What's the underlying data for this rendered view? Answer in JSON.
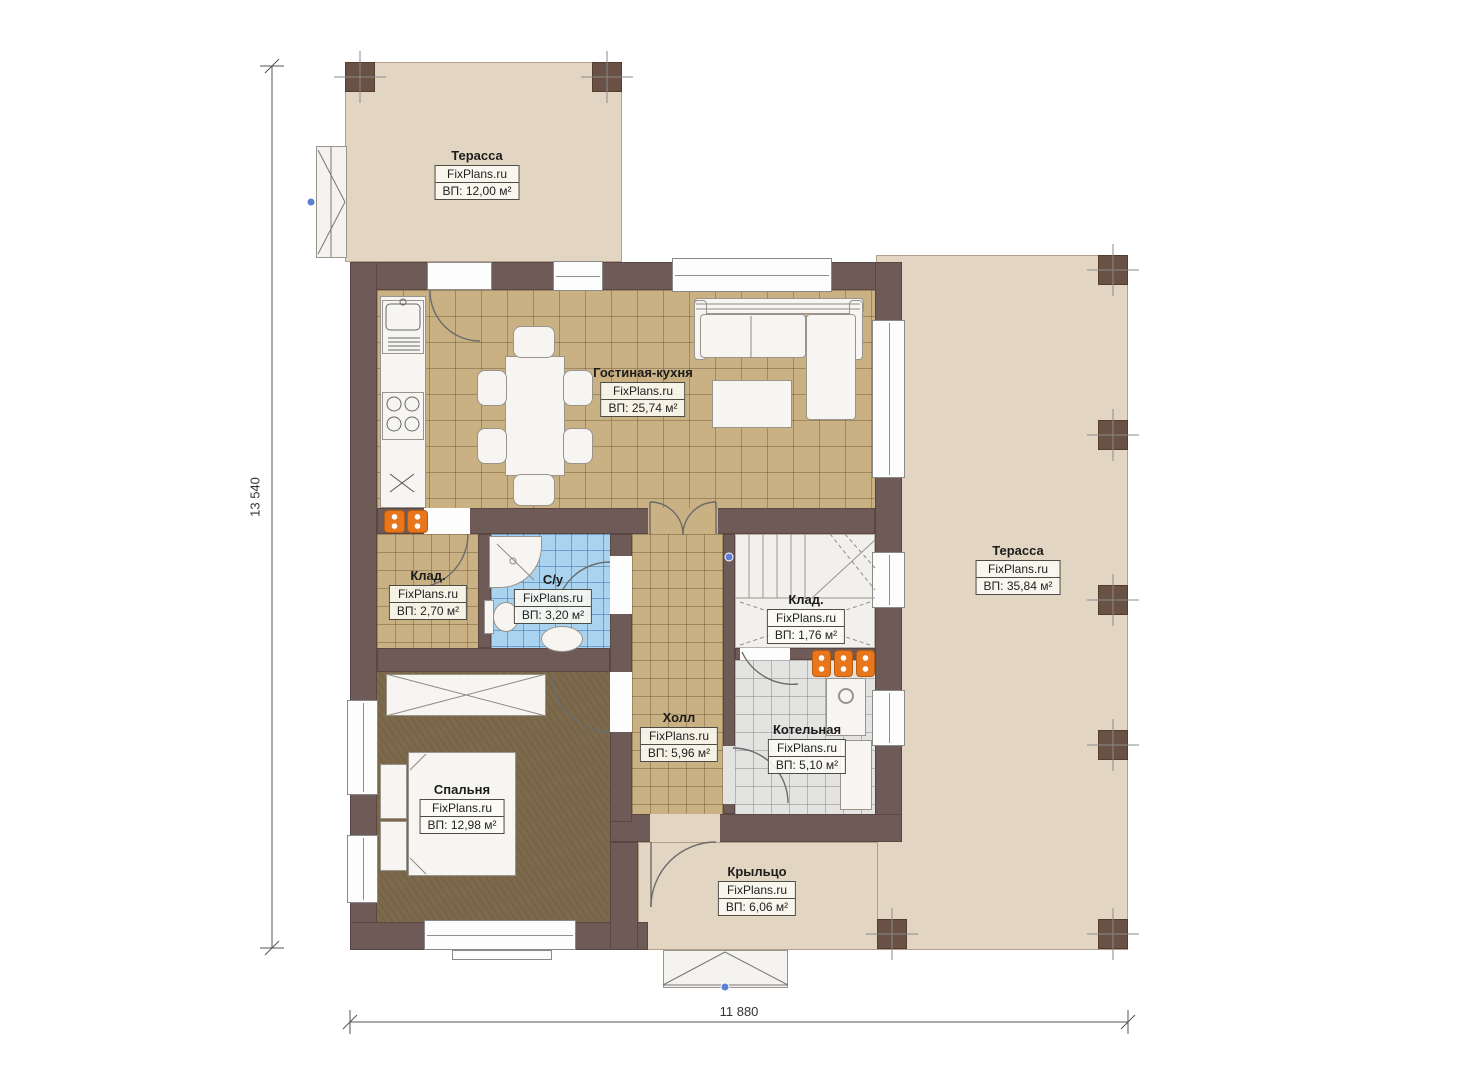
{
  "plan": {
    "brand": "FixPlans.ru",
    "dimensions": {
      "total_height_mm": "13 540",
      "total_width_mm": "11 880"
    },
    "rooms": [
      {
        "id": "terrace-top",
        "name": "Терасса",
        "area": "ВП: 12,00 м²"
      },
      {
        "id": "living-kitchen",
        "name": "Гостиная-кухня",
        "area": "ВП: 25,74 м²"
      },
      {
        "id": "storage-small",
        "name": "Клад.",
        "area": "ВП: 2,70 м²"
      },
      {
        "id": "bathroom",
        "name": "С/у",
        "area": "ВП: 3,20 м²"
      },
      {
        "id": "storage-under-stairs",
        "name": "Клад.",
        "area": "ВП: 1,76 м²"
      },
      {
        "id": "terrace-right",
        "name": "Терасса",
        "area": "ВП: 35,84 м²"
      },
      {
        "id": "hall",
        "name": "Холл",
        "area": "ВП: 5,96 м²"
      },
      {
        "id": "boiler-room",
        "name": "Котельная",
        "area": "ВП: 5,10 м²"
      },
      {
        "id": "bedroom",
        "name": "Спальня",
        "area": "ВП: 12,98 м²"
      },
      {
        "id": "porch",
        "name": "Крыльцо",
        "area": "ВП: 6,06 м²"
      }
    ],
    "colors": {
      "wall": "#6e5a57",
      "terrace_floor": "#e2d5c1",
      "tile_tan": "#c9b183",
      "tile_blue": "#a9d3ef",
      "tile_gray": "#e3e3e1",
      "wood_floor": "#7d6a4c",
      "equipment_orange": "#e8761c"
    }
  }
}
